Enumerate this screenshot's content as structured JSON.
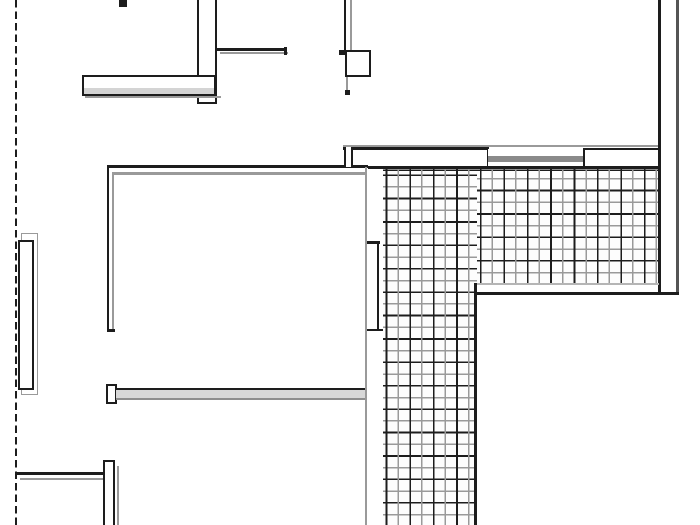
{
  "meta": {
    "description": "Monochrome architectural floor plan (partial plan view). A dashed site/boundary line runs along the left edge. Several double-line walls with end caps form two rooms and a corridor. An L-shaped exterior area (terrace/roof) is filled with a fine square grid hatch. Small window/door symbols and a square column appear along the top walls. No text labels are visible.",
    "width_px": 700,
    "height_px": 525
  },
  "palette": {
    "background": "#ffffff",
    "line_dark": "#1d1d1d",
    "line_gray": "#9a9a9a",
    "wall_fill_light": "#d8d8d8",
    "window_bar_gray": "#8a8a8a"
  },
  "hatch": {
    "pattern": "square-grid",
    "minor_spacing_px": 11.7,
    "major_spacing_px": 23.4,
    "areas": [
      "vertical arm x:383-477 y:168-525",
      "horizontal arm x:477-658 y:168-283"
    ]
  },
  "labels": {}
}
